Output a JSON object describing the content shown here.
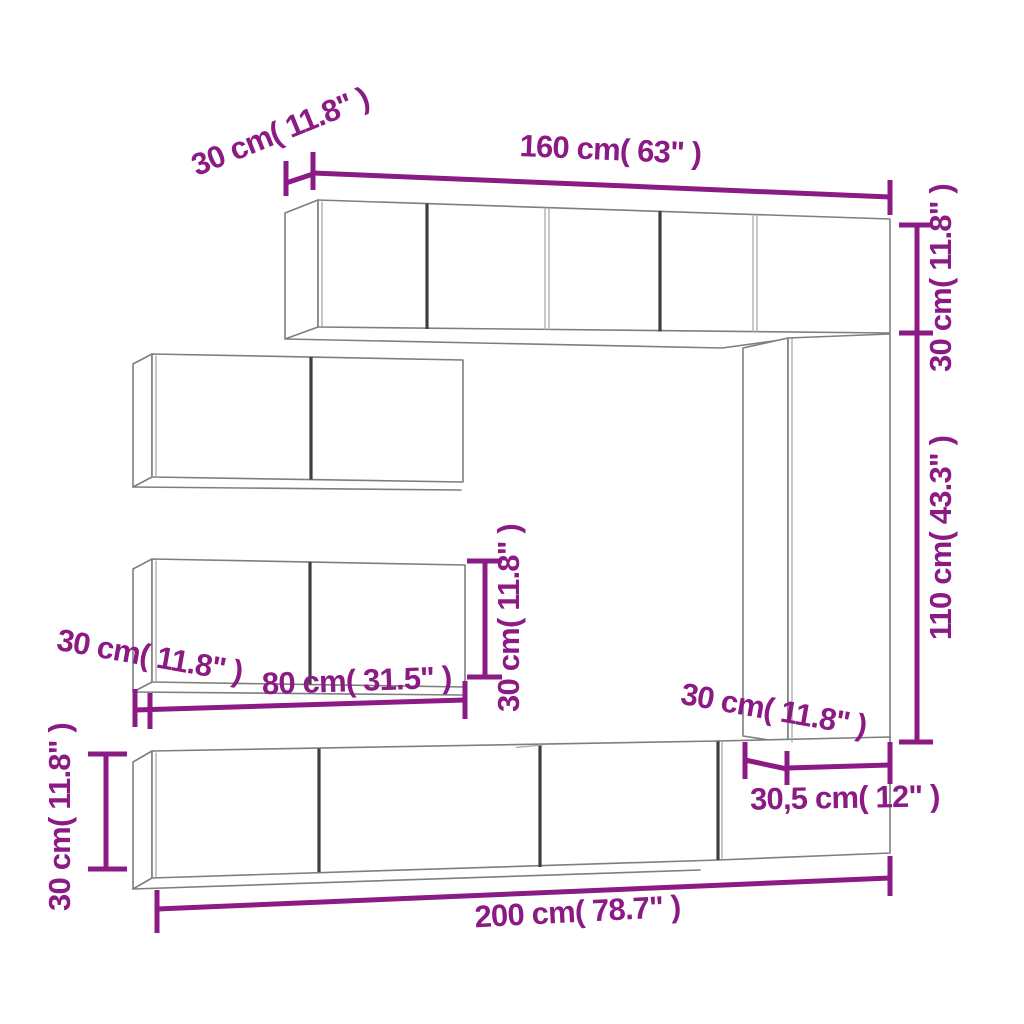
{
  "diagram_title": "TV wall unit set dimension diagram",
  "colors": {
    "dimension": "#8B1A84",
    "outline": "#7E7E7E",
    "door_gap": "#3F3F3F",
    "junction": "#A9A9A9",
    "background": "#FFFFFF"
  },
  "dimensions": {
    "top_cabinet_depth": "30 cm( 11.8\" )",
    "top_cabinet_width": "160 cm( 63\" )",
    "upper_right_height": "30 cm( 11.8\" )",
    "right_column_height": "110 cm( 43.3\" )",
    "wall_cabinet_height": "30 cm( 11.8\" )",
    "wall_cabinet_depth": "30 cm( 11.8\" )",
    "wall_cabinet_width": "80 cm( 31.5\" )",
    "tv_stand_height": "30 cm( 11.8\" )",
    "side_unit_depth": "30 cm( 11.8\" )",
    "side_unit_width": "30,5 cm( 12\" )",
    "tv_stand_width": "200 cm( 78.7\" )"
  }
}
